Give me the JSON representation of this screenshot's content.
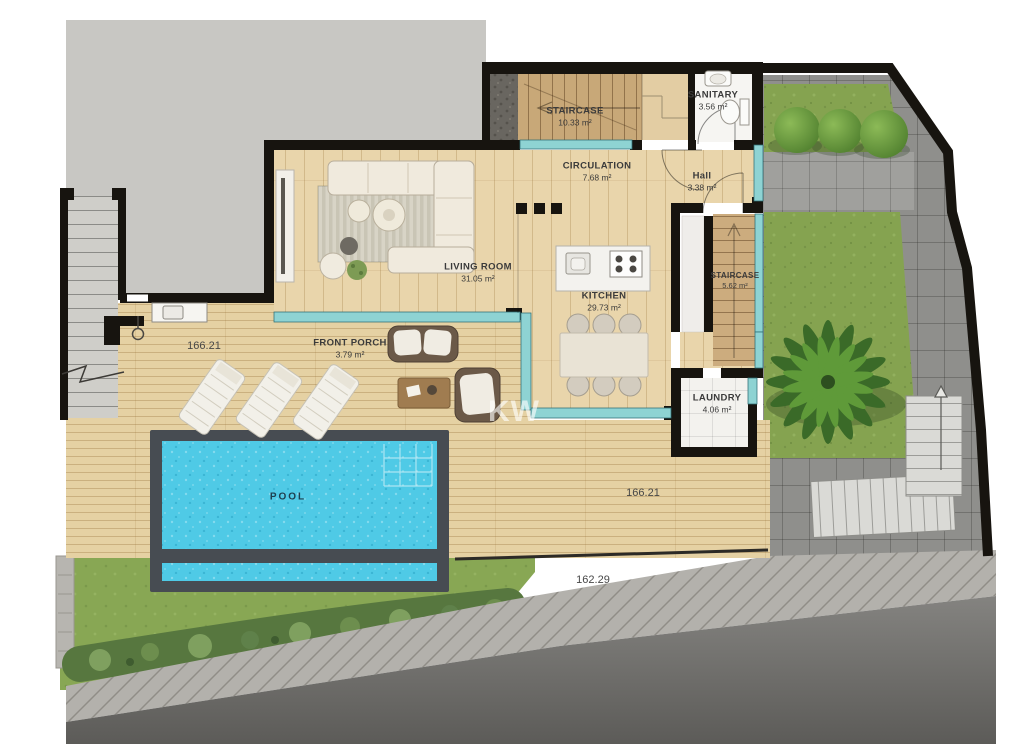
{
  "plan": {
    "title": "Ground floor plan",
    "watermark": "KW",
    "rooms": [
      {
        "id": "staircase-upper",
        "name": "STAIRCASE",
        "area": "10.33 m²"
      },
      {
        "id": "sanitary",
        "name": "SANITARY",
        "area": "3.56 m²"
      },
      {
        "id": "circulation",
        "name": "CIRCULATION",
        "area": "7.68 m²"
      },
      {
        "id": "hall",
        "name": "Hall",
        "area": "3.38 m²"
      },
      {
        "id": "living-room",
        "name": "LIVING ROOM",
        "area": "31.05 m²"
      },
      {
        "id": "kitchen",
        "name": "KITCHEN",
        "area": "29.73 m²"
      },
      {
        "id": "staircase-right",
        "name": "STAIRCASE",
        "area": "5.62 m²"
      },
      {
        "id": "laundry",
        "name": "LAUNDRY",
        "area": "4.06 m²"
      },
      {
        "id": "front-porch",
        "name": "FRONT PORCH",
        "area": "3.79 m²"
      },
      {
        "id": "pool",
        "name": "POOL",
        "area": ""
      }
    ],
    "dimensions": [
      {
        "id": "terrace-left",
        "value": "166.21"
      },
      {
        "id": "terrace-right",
        "value": "166.21"
      },
      {
        "id": "driveway",
        "value": "162.29"
      }
    ],
    "colors": {
      "pool_water": "#4fcae6",
      "glazing": "#8ed3d3",
      "wood_floor": "#e9d5ab",
      "deck": "#e5d1a3",
      "walls": "#17140f",
      "grass": "#85a350",
      "neighbor_parcel": "#c8c7c3"
    }
  }
}
